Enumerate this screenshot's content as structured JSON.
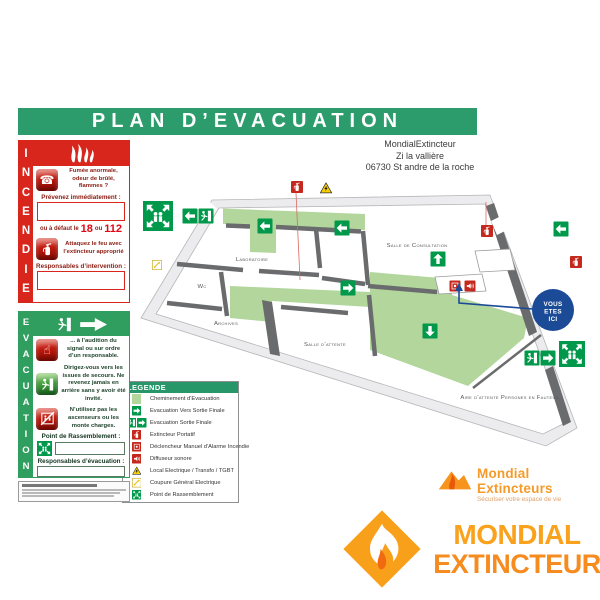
{
  "header": {
    "title": "PLAN D’EVACUATION"
  },
  "address": {
    "line1": "MondialExtincteur",
    "line2": "Zi la vallière",
    "line3": "06730 St andre de la roche"
  },
  "incendie": {
    "title": "INCENDIE",
    "step1_text": "Fumée anormale, odeur de brûlé, flammes ?",
    "step1_label": "Prévenez immédiatement :",
    "fallback_prefix": "ou à défaut le",
    "fallback_num1": "18",
    "fallback_or": "ou",
    "fallback_num2": "112",
    "step2_text": "Attaquez le feu avec l’extincteur approprié",
    "step2_label": "Responsables d’intervention :"
  },
  "evacuation": {
    "title": "EVACUATION",
    "rule1": "... à l’audition du signal ou sur ordre d’un responsable.",
    "rule2": "Dirigez-vous vers les issues de secours. Ne revenez jamais en arrière sans y avoir été invité.",
    "rule3": "N’utilisez pas les ascenseurs ou les monte charges.",
    "assembly_label": "Point de Rassemblement :",
    "resp_label": "Responsables d’évacuation :",
    "accident_label": "En cas d’accident prévenir :"
  },
  "legend": {
    "title": "LEGENDE",
    "items": [
      {
        "icon": "path-swatch",
        "label": "Cheminement d’Evacuation"
      },
      {
        "icon": "arrow-right-green",
        "label": "Evacuation Vers Sortie Finale"
      },
      {
        "icon": "exit-plus-arrow",
        "label": "Evacuation Sortie Finale"
      },
      {
        "icon": "extinguisher",
        "label": "Extincteur Portatif"
      },
      {
        "icon": "manual-alarm",
        "label": "Déclencheur Manuel d’Alarme Incendie"
      },
      {
        "icon": "sounder",
        "label": "Diffuseur sonore"
      },
      {
        "icon": "warning-triangle",
        "label": "Local Electrique / Transfo / TGBT"
      },
      {
        "icon": "power-cut",
        "label": "Coupure Général Electrique"
      },
      {
        "icon": "assembly-point",
        "label": "Point de Rassemblement"
      }
    ]
  },
  "plan": {
    "you_are_here": [
      "VOUS",
      "ETES",
      "ICI"
    ],
    "rooms": [
      {
        "label": "Laboratoire",
        "x": 252,
        "y": 261
      },
      {
        "label": "Wc",
        "x": 202,
        "y": 288
      },
      {
        "label": "Archives",
        "x": 226,
        "y": 325
      },
      {
        "label": "Salle de Consultation",
        "x": 417,
        "y": 247
      },
      {
        "label": "Salle d’attente",
        "x": 325,
        "y": 346
      },
      {
        "label": "Aire d’attente Persones en Fauteuil",
        "x": 510,
        "y": 399
      }
    ],
    "icons": [
      {
        "type": "assembly",
        "x": 158,
        "y": 216,
        "s": 30
      },
      {
        "type": "arrow",
        "dir": "left",
        "x": 190,
        "y": 216,
        "s": 15
      },
      {
        "type": "exit",
        "x": 206,
        "y": 216,
        "s": 15
      },
      {
        "type": "powercut",
        "x": 157,
        "y": 265,
        "s": 10
      },
      {
        "type": "ext",
        "x": 297,
        "y": 187,
        "s": 12
      },
      {
        "type": "warning",
        "x": 326,
        "y": 188,
        "s": 13
      },
      {
        "type": "arrow",
        "dir": "left",
        "x": 265,
        "y": 226,
        "s": 15
      },
      {
        "type": "arrow",
        "dir": "left",
        "x": 342,
        "y": 228,
        "s": 15
      },
      {
        "type": "arrow",
        "dir": "left",
        "x": 561,
        "y": 229,
        "s": 15
      },
      {
        "type": "ext",
        "x": 487,
        "y": 231,
        "s": 12
      },
      {
        "type": "ext",
        "x": 576,
        "y": 262,
        "s": 12
      },
      {
        "type": "arrow",
        "dir": "up",
        "x": 438,
        "y": 259,
        "s": 15
      },
      {
        "type": "alarm",
        "x": 455,
        "y": 286,
        "s": 11
      },
      {
        "type": "sounder",
        "x": 470,
        "y": 286,
        "s": 11
      },
      {
        "type": "arrow",
        "dir": "right",
        "x": 348,
        "y": 288,
        "s": 15
      },
      {
        "type": "arrow",
        "dir": "down",
        "x": 430,
        "y": 331,
        "s": 15
      },
      {
        "type": "exit",
        "x": 532,
        "y": 358,
        "s": 15
      },
      {
        "type": "arrow",
        "dir": "right",
        "x": 548,
        "y": 358,
        "s": 15
      },
      {
        "type": "assembly",
        "x": 572,
        "y": 354,
        "s": 26
      }
    ]
  },
  "footer": {
    "brand_name": "Mondial Extincteurs",
    "brand_tagline": "Sécuriser votre espace de vie",
    "logo_line1": "MONDIAL",
    "logo_line2": "EXTINCTEUR"
  },
  "colors": {
    "header_green": "#2d9c6d",
    "incendie_red": "#d9261c",
    "evacuation_green": "#2f9e5e",
    "path_green": "#b2d69b",
    "picto_green": "#00984a",
    "alert_red": "#c5281c",
    "warning_yellow": "#f6cf06",
    "you_are_here_blue": "#1b4a97",
    "logo_orange": "#f7941d"
  }
}
